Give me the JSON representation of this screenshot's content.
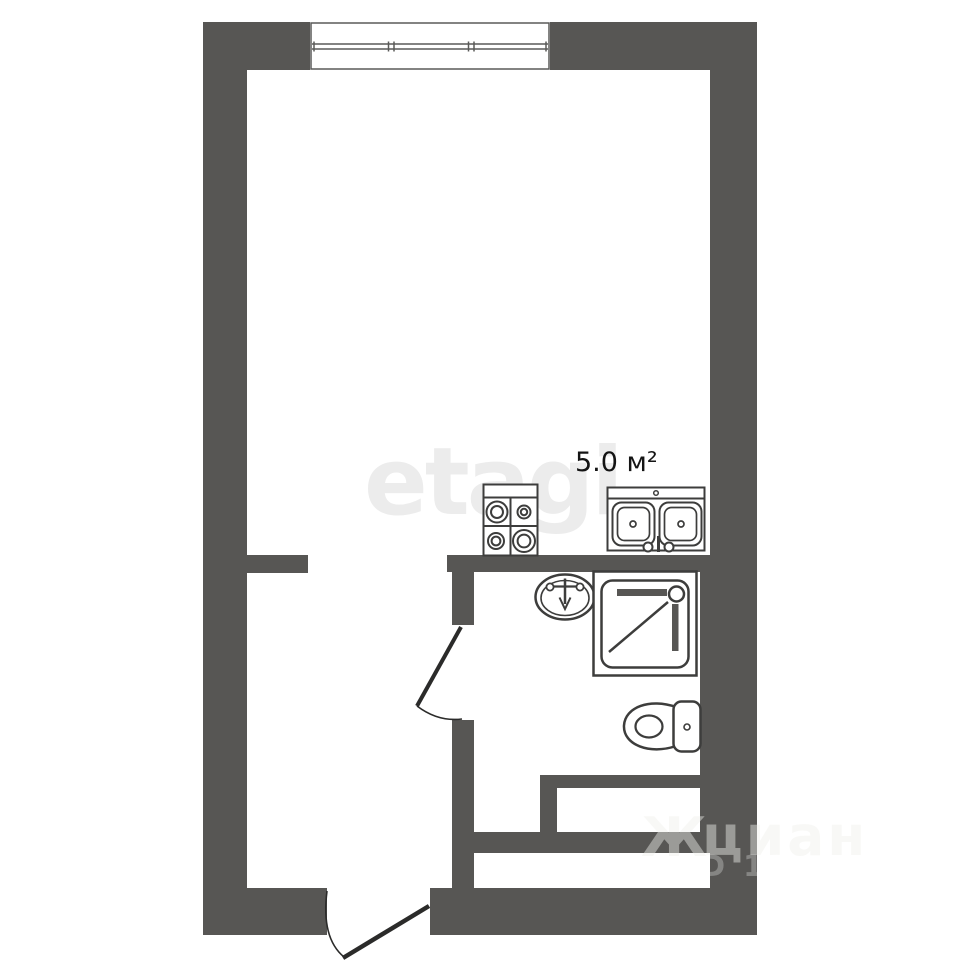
{
  "floorplan": {
    "area_label": "5.0 м²",
    "watermarks": {
      "etagi": "etagi",
      "cian_logo": "Ж",
      "cian": "циан",
      "listing_id": "D 12"
    },
    "colors": {
      "background": "#ffffff",
      "wall": "#575654",
      "fixture_stroke": "#3d3d3c",
      "window_stroke": "#5a5a58",
      "door_stroke": "#2b2b2a",
      "etagi_watermark": "#ececec",
      "area_text": "#141414",
      "cian_watermark": "rgba(240,240,236,0.45)",
      "cian_id_watermark": "rgba(255,255,255,0.28)"
    },
    "fixtures": [
      "window",
      "stove",
      "kitchen-sink",
      "washbasin",
      "shower-cabin",
      "toilet"
    ],
    "doors": [
      "interior-door",
      "entry-door"
    ]
  }
}
